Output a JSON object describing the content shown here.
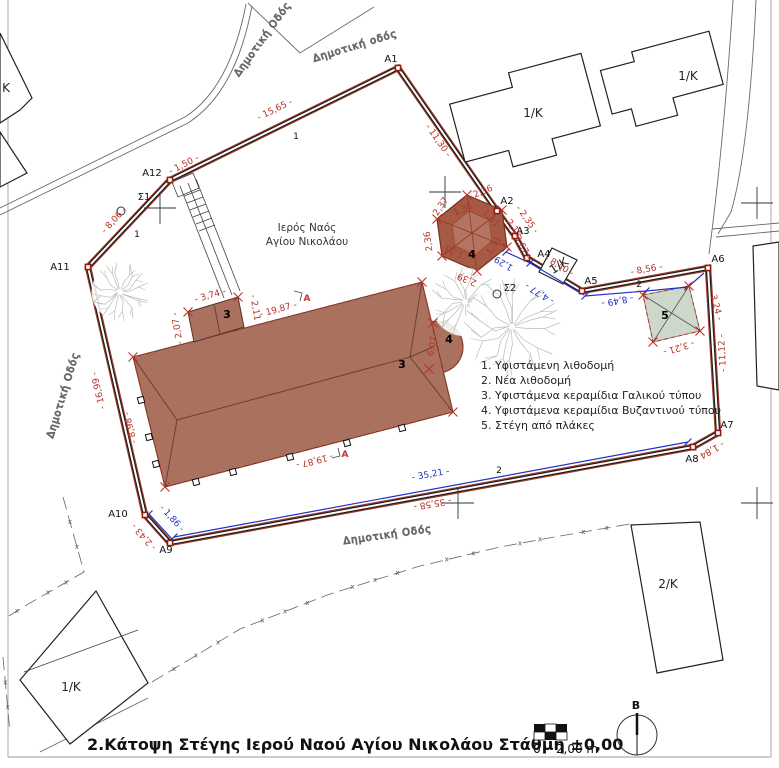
{
  "drawing": {
    "title": "2.Κάτοψη Στέγης Ιερού Ναού Αγίου Νικολάου Στάθμη ±0,00",
    "north_label": "B",
    "scale_zero": "0",
    "scale_value": "2,00 m"
  },
  "site": {
    "name_line1": "Ιερός Ναός",
    "name_line2": "Αγίου Νικολάου"
  },
  "legend": [
    "1. Υφιστάμενη λιθοδομή",
    "2. Νέα λιθοδομή",
    "3. Υφιστάμενα κεραμίδια Γαλικού τύπου",
    "4. Υφιστάμενα κεραμίδια Βυζαντινού τύπου",
    "5. Στέγη από πλάκες"
  ],
  "colors": {
    "dimension_red": "#b5342a",
    "dimension_blue": "#2233c4",
    "roof_brown": "#a9715e",
    "hexagon_brown": "#a55a44",
    "slab_green": "#cdd8cb"
  },
  "annotations": [
    {
      "n": "dimension-red",
      "t": "- 15,65 -",
      "x": 276,
      "y": 112,
      "r": -26,
      "c": "red"
    },
    {
      "n": "dimension-red",
      "t": "- 1,50 -",
      "x": 185,
      "y": 167,
      "r": -27,
      "c": "red"
    },
    {
      "n": "dimension-red",
      "t": "- 11,30 -",
      "x": 436,
      "y": 142,
      "r": 55,
      "c": "red"
    },
    {
      "n": "dimension-red",
      "t": "- 8,06 -",
      "x": 116,
      "y": 222,
      "r": -47,
      "c": "red"
    },
    {
      "n": "dimension-red",
      "t": "- 16,99 -",
      "x": 101,
      "y": 390,
      "r": -103,
      "c": "red"
    },
    {
      "n": "dimension-red",
      "t": "- 2,43 -",
      "x": 146,
      "y": 535,
      "r": -132,
      "c": "red"
    },
    {
      "n": "dimension-red",
      "t": "- 35,58 -",
      "x": 432,
      "y": 501,
      "r": 170,
      "c": "red"
    },
    {
      "n": "dimension-red",
      "t": "- 1,84 -",
      "x": 708,
      "y": 449,
      "r": 151,
      "c": "red"
    },
    {
      "n": "dimension-red",
      "t": "- 11,12 -",
      "x": 725,
      "y": 353,
      "r": -93,
      "c": "red"
    },
    {
      "n": "dimension-red",
      "t": "- 8,56 -",
      "x": 647,
      "y": 272,
      "r": -10,
      "c": "red"
    },
    {
      "n": "dimension-red",
      "t": "- 8,40 -",
      "x": 558,
      "y": 268,
      "r": 31,
      "c": "red"
    },
    {
      "n": "dimension-red",
      "t": "- 3,67 -",
      "x": 519,
      "y": 246,
      "r": 61,
      "c": "red"
    },
    {
      "n": "dimension-red",
      "t": "- 2,35 -",
      "x": 525,
      "y": 221,
      "r": 54,
      "c": "red"
    },
    {
      "n": "dimension-red",
      "t": "- 3,74 -",
      "x": 211,
      "y": 298,
      "r": -16,
      "c": "red"
    },
    {
      "n": "dimension-red",
      "t": "- 2,11 -",
      "x": 253,
      "y": 311,
      "r": 80,
      "c": "red"
    },
    {
      "n": "dimension-red",
      "t": "- 2,07 -",
      "x": 180,
      "y": 328,
      "r": -100,
      "c": "red"
    },
    {
      "n": "dimension-red",
      "t": "- 19,87 -",
      "x": 279,
      "y": 312,
      "r": -15,
      "c": "red"
    },
    {
      "n": "dimension-red",
      "t": "- 19,87 -",
      "x": 314,
      "y": 458,
      "r": 166,
      "c": "red"
    },
    {
      "n": "dimension-red",
      "t": "- 8,98 -",
      "x": 133,
      "y": 427,
      "r": -104,
      "c": "red"
    },
    {
      "n": "dimension-red",
      "t": "6,07",
      "x": 435,
      "y": 347,
      "r": -78,
      "c": "red",
      "s": 8
    },
    {
      "n": "dimension-red",
      "t": "- 3,24 -",
      "x": 713,
      "y": 305,
      "r": 75,
      "c": "red"
    },
    {
      "n": "dimension-red",
      "t": "- 3,21 -",
      "x": 678,
      "y": 345,
      "r": 163,
      "c": "red"
    },
    {
      "n": "dimension-red",
      "t": "2,36",
      "x": 484,
      "y": 194,
      "r": -22,
      "c": "red",
      "s": 7.5
    },
    {
      "n": "dimension-red",
      "t": "2,37",
      "x": 443,
      "y": 208,
      "r": -56,
      "c": "red",
      "s": 7.5
    },
    {
      "n": "dimension-red",
      "t": "2,36",
      "x": 431,
      "y": 241,
      "r": -98,
      "c": "red",
      "s": 7.5
    },
    {
      "n": "dimension-red",
      "t": "2,39",
      "x": 468,
      "y": 277,
      "r": -157,
      "c": "red",
      "s": 7.5
    },
    {
      "n": "dimension-red",
      "t": "2,12",
      "x": 512,
      "y": 230,
      "r": 52,
      "c": "red",
      "s": 7.5
    },
    {
      "n": "dimension-red",
      "t": "1,36",
      "x": 464,
      "y": 212,
      "r": -22,
      "c": "red",
      "s": 7
    },
    {
      "n": "dimension-red",
      "t": "1,31",
      "x": 489,
      "y": 220,
      "r": 48,
      "c": "red",
      "s": 7
    },
    {
      "n": "dimension-red",
      "t": "1,31",
      "x": 496,
      "y": 247,
      "r": -55,
      "c": "red",
      "s": 7
    },
    {
      "n": "dimension-red",
      "t": "1,31",
      "x": 455,
      "y": 249,
      "r": -156,
      "c": "red",
      "s": 7
    },
    {
      "n": "dimension-blue",
      "t": "- 35,21 -",
      "x": 431,
      "y": 477,
      "r": -10,
      "c": "blue"
    },
    {
      "n": "dimension-blue",
      "t": "- 1,86 -",
      "x": 170,
      "y": 520,
      "r": 48,
      "c": "blue"
    },
    {
      "n": "dimension-blue",
      "t": "- 8,49 -",
      "x": 617,
      "y": 298,
      "r": 170,
      "c": "blue"
    },
    {
      "n": "dimension-blue",
      "t": "- 4,77 -",
      "x": 541,
      "y": 291,
      "r": -149,
      "c": "blue"
    },
    {
      "n": "dimension-blue",
      "t": "1,29",
      "x": 505,
      "y": 261,
      "r": -149,
      "c": "blue",
      "s": 8
    },
    {
      "n": "line-number",
      "t": "1",
      "x": 296,
      "y": 139,
      "c": "bal"
    },
    {
      "n": "line-number",
      "t": "1",
      "x": 137,
      "y": 237,
      "c": "bal"
    },
    {
      "n": "line-number",
      "t": "2",
      "x": 639,
      "y": 287,
      "c": "bal"
    },
    {
      "n": "line-number",
      "t": "2",
      "x": 499,
      "y": 473,
      "c": "bal"
    },
    {
      "n": "point-label",
      "t": "A1",
      "x": 391,
      "y": 62,
      "c": "pt"
    },
    {
      "n": "point-label",
      "t": "A2",
      "x": 507,
      "y": 204,
      "c": "pt"
    },
    {
      "n": "point-label",
      "t": "A3",
      "x": 523,
      "y": 234,
      "c": "pt"
    },
    {
      "n": "point-label",
      "t": "A4",
      "x": 544,
      "y": 257,
      "c": "pt"
    },
    {
      "n": "point-label",
      "t": "A5",
      "x": 591,
      "y": 284,
      "c": "pt"
    },
    {
      "n": "point-label",
      "t": "A6",
      "x": 718,
      "y": 262,
      "c": "pt"
    },
    {
      "n": "point-label",
      "t": "A7",
      "x": 727,
      "y": 428,
      "c": "pt"
    },
    {
      "n": "point-label",
      "t": "A8",
      "x": 692,
      "y": 462,
      "c": "pt"
    },
    {
      "n": "point-label",
      "t": "A9",
      "x": 166,
      "y": 553,
      "c": "pt"
    },
    {
      "n": "point-label",
      "t": "A10",
      "x": 118,
      "y": 517,
      "c": "pt"
    },
    {
      "n": "point-label",
      "t": "A11",
      "x": 60,
      "y": 270,
      "c": "pt"
    },
    {
      "n": "point-label",
      "t": "A12",
      "x": 152,
      "y": 176,
      "c": "pt"
    },
    {
      "n": "point-label",
      "t": "Σ1",
      "x": 144,
      "y": 200,
      "c": "pt"
    },
    {
      "n": "point-label",
      "t": "Σ2",
      "x": 510,
      "y": 291,
      "c": "pt"
    },
    {
      "n": "roof-number",
      "t": "3",
      "x": 227,
      "y": 318,
      "c": "num"
    },
    {
      "n": "roof-number",
      "t": "3",
      "x": 402,
      "y": 368,
      "c": "num"
    },
    {
      "n": "roof-number",
      "t": "4",
      "x": 472,
      "y": 258,
      "c": "num"
    },
    {
      "n": "roof-number",
      "t": "4",
      "x": 449,
      "y": 343,
      "c": "num"
    },
    {
      "n": "roof-number",
      "t": "5",
      "x": 665,
      "y": 319,
      "c": "num"
    },
    {
      "n": "building-label",
      "t": "1/K",
      "x": 533,
      "y": 117,
      "c": "bld"
    },
    {
      "n": "building-label",
      "t": "1/K",
      "x": 688,
      "y": 80,
      "c": "bld"
    },
    {
      "n": "building-label",
      "t": "1/K",
      "x": 561,
      "y": 269,
      "r": -33,
      "c": "bld",
      "s": 10
    },
    {
      "n": "building-label",
      "t": "1/K",
      "x": 71,
      "y": 691,
      "c": "bld"
    },
    {
      "n": "building-label",
      "t": "2/K",
      "x": 668,
      "y": 588,
      "c": "bld"
    },
    {
      "n": "building-label",
      "t": "K",
      "x": 6,
      "y": 92,
      "c": "bld",
      "s": 11
    },
    {
      "n": "road-label",
      "t": "Δημοτική Οδός",
      "x": 265,
      "y": 41,
      "r": -54,
      "c": "road"
    },
    {
      "n": "road-label",
      "t": "Δημοτική οδός",
      "x": 356,
      "y": 49,
      "r": -17,
      "c": "road"
    },
    {
      "n": "road-label",
      "t": "Δημοτική Οδός",
      "x": 66,
      "y": 396,
      "r": -73,
      "c": "road"
    },
    {
      "n": "road-label",
      "t": "Δημοτική Οδός",
      "x": 388,
      "y": 538,
      "r": -8,
      "c": "road"
    },
    {
      "n": "section-marker",
      "t": "A",
      "x": 307,
      "y": 301,
      "c": "secA"
    },
    {
      "n": "section-marker",
      "t": "A",
      "x": 345,
      "y": 457,
      "c": "secA"
    }
  ]
}
